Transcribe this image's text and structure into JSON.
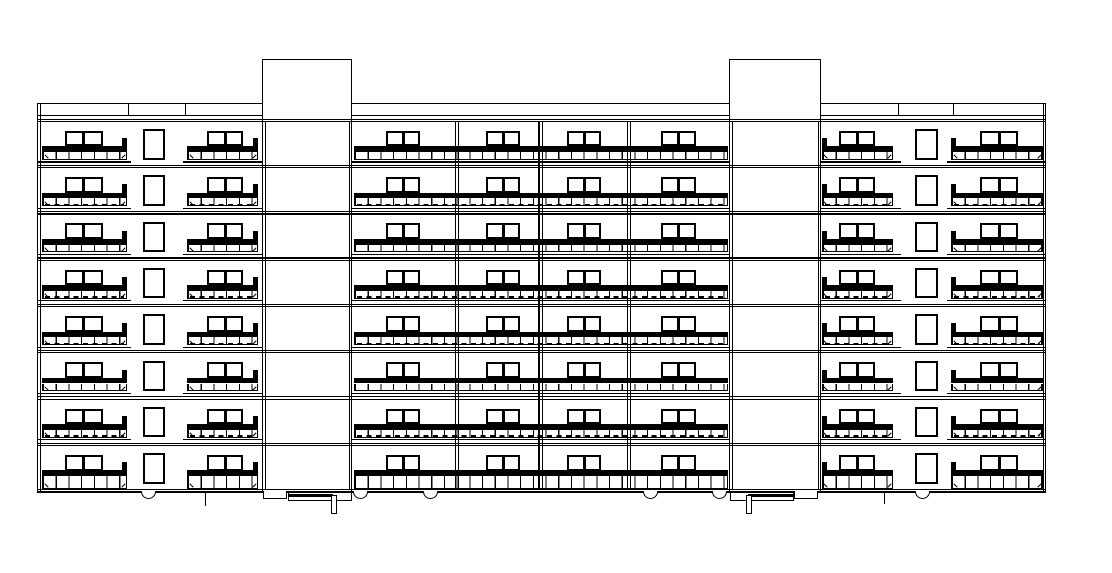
{
  "drawing_title": "eight-storey-apartment-building-front-elevation",
  "elevation": {
    "ink": "#000000",
    "background": "#ffffff",
    "canvas": {
      "w": 1112,
      "h": 573
    },
    "building": {
      "left": 37,
      "right": 1046,
      "edge_gap": 3.2,
      "band_top": 103.3,
      "band_mid": 115.3,
      "first_floor_top": 118.5,
      "floor_pitch": 46.3,
      "floor_count": 8,
      "ground_top": 488.9,
      "ground_bottom": 491.3
    },
    "band_segments": [
      [
        37,
        262
      ],
      [
        352,
        730
      ],
      [
        821,
        1046
      ]
    ],
    "band_joints": [
      128,
      185,
      898,
      953
    ],
    "towers": [
      {
        "left": 262,
        "right": 352,
        "top": 59
      },
      {
        "left": 729,
        "right": 821,
        "top": 59
      }
    ],
    "party_walls": [
      456.5,
      540,
      628.5
    ],
    "floor_module": {
      "win_dy": 12.3,
      "win_h": 15.7,
      "win_frame": 2.4,
      "mullion_w": 3,
      "bar_dy": 27.8,
      "bar_h": 5.7,
      "rail_dy": 33.5,
      "rail_h": 7.8,
      "rail_segment": 12.7,
      "lip_dy": 42.8,
      "lip_h": 1.3,
      "stair_dy": 10.5,
      "stair_h": 30.5,
      "stair_frame": 2.4,
      "stub_w": 5,
      "stub_dy": 19.5
    },
    "balconies": [
      {
        "x1": 42,
        "x2": 127,
        "windows": [
          [
            64.5,
            102.5
          ]
        ],
        "lip": [
          37,
          131
        ],
        "stub": "right"
      },
      {
        "x1": 187,
        "x2": 258,
        "windows": [
          [
            207,
            243
          ]
        ],
        "lip": [
          183,
          263
        ],
        "stub": "right"
      },
      {
        "x1": 354,
        "x2": 728,
        "windows": [
          [
            386,
            420
          ],
          [
            486,
            520
          ],
          [
            567,
            601
          ],
          [
            661,
            696
          ]
        ],
        "lip": [
          352,
          730
        ],
        "stub": "none"
      },
      {
        "x1": 821.5,
        "x2": 893,
        "windows": [
          [
            839,
            875
          ]
        ],
        "lip": [
          821,
          901
        ],
        "stub": "left"
      },
      {
        "x1": 951,
        "x2": 1043,
        "windows": [
          [
            980,
            1018
          ]
        ],
        "lip": [
          947,
          1046
        ],
        "stub": "left"
      }
    ],
    "stair_windows": [
      [
        143,
        165
      ],
      [
        915,
        937.5
      ]
    ],
    "dashed_rail_rows": [
      2,
      4,
      5,
      7
    ],
    "canopies": [
      {
        "slab": [
          288,
          352
        ],
        "bar": [
          288,
          333
        ],
        "post_x": 331,
        "step": [
          263,
          287
        ]
      },
      {
        "slab": [
          730,
          794
        ],
        "bar": [
          748,
          793
        ],
        "post_x": 746,
        "step": [
          794,
          818
        ]
      }
    ],
    "canopy_y": {
      "top": 492.3,
      "bottom": 500.6,
      "bar_top": 494.2,
      "bar_h": 3.2
    },
    "post": {
      "w": 5.5,
      "top": 495,
      "bottom": 513.5
    },
    "step_y": {
      "top": 491,
      "bottom": 498.8
    },
    "vents": {
      "centers": [
        148,
        360,
        430,
        650,
        719,
        922
      ],
      "w": 15,
      "h": 7.5,
      "y": 491
    },
    "downspouts": [
      {
        "x": 205,
        "y1": 491,
        "y2": 506
      },
      {
        "x": 884,
        "y1": 491,
        "y2": 504
      }
    ]
  }
}
